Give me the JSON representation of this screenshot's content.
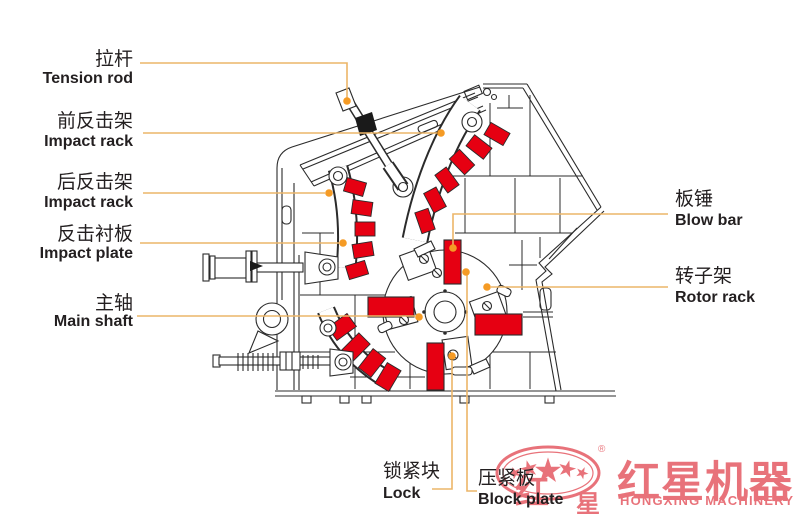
{
  "labels": {
    "left": [
      {
        "zh": "拉杆",
        "en": "Tension rod"
      },
      {
        "zh": "前反击架",
        "en": "Impact rack"
      },
      {
        "zh": "后反击架",
        "en": "Impact rack"
      },
      {
        "zh": "反击衬板",
        "en": "Impact plate"
      },
      {
        "zh": "主轴",
        "en": "Main shaft"
      }
    ],
    "right": [
      {
        "zh": "板锤",
        "en": "Blow bar"
      },
      {
        "zh": "转子架",
        "en": "Rotor rack"
      }
    ],
    "bottom": [
      {
        "zh": "锁紧块",
        "en": "Lock"
      },
      {
        "zh": "压紧板",
        "en": "Block plate"
      }
    ]
  },
  "logo": {
    "main": "红星机器",
    "sub": "HONGXING MACHINERY",
    "reg": "®",
    "char_hong": "红",
    "char_xing": "星",
    "brand_color": "#d7000f"
  },
  "diagram": {
    "subject": "impact crusher cross-section",
    "highlight_color": "#e60012",
    "line_color": "#2b2b2b",
    "leader_line_color": "#ecb568",
    "leader_dot_color": "#f59b25"
  }
}
